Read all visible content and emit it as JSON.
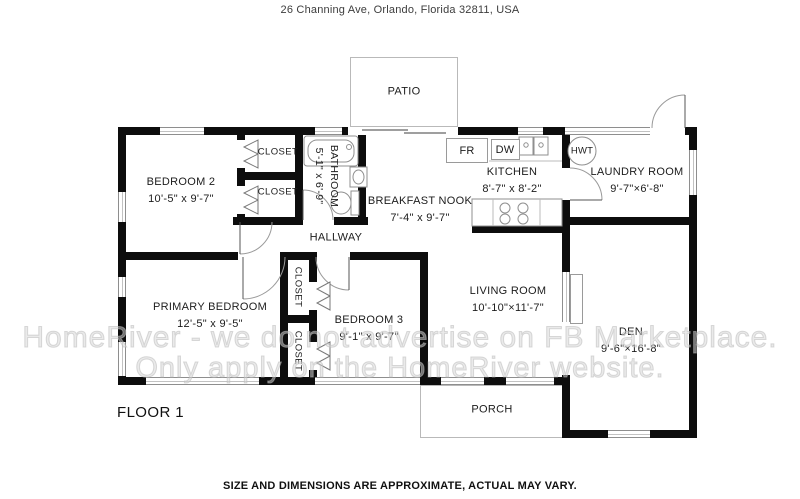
{
  "header": {
    "address": "26 Channing Ave, Orlando, Florida 32811, USA"
  },
  "watermark": {
    "line1": "HomeRiver - we do not advertise on FB Marketplace.",
    "line2": "Only apply on the HomeRiver website."
  },
  "floor": {
    "label": "FLOOR 1"
  },
  "disclaimer": {
    "text": "SIZE AND DIMENSIONS ARE APPROXIMATE, ACTUAL MAY VARY."
  },
  "rooms": {
    "bedroom2": {
      "name": "BEDROOM 2",
      "dims": "10'-5\" x 9'-7\""
    },
    "closet_a": {
      "name": "CLOSET"
    },
    "closet_b": {
      "name": "CLOSET"
    },
    "bathroom": {
      "name": "BATHROOM",
      "dims": "5'-1\" x 6'-9\""
    },
    "breakfast_nook": {
      "name": "BREAKFAST NOOK",
      "dims": "7'-4\" x 9'-7\""
    },
    "kitchen": {
      "name": "KITCHEN",
      "dims": "8'-7\" x 8'-2\""
    },
    "laundry": {
      "name": "LAUNDRY ROOM",
      "dims": "9'-7\"×6'-8\""
    },
    "hallway": {
      "name": "HALLWAY"
    },
    "primary_bedroom": {
      "name": "PRIMARY BEDROOM",
      "dims": "12'-5\" x 9'-5\""
    },
    "closet_c": {
      "name": "CLOSET"
    },
    "closet_d": {
      "name": "CLOSET"
    },
    "bedroom3": {
      "name": "BEDROOM 3",
      "dims": "9'-1\" x 9'-7\""
    },
    "living_room": {
      "name": "LIVING ROOM",
      "dims": "10'-10\"×11'-7\""
    },
    "den": {
      "name": "DEN",
      "dims": "9'-6\"×16'-8\""
    },
    "patio": {
      "name": "PATIO"
    },
    "porch": {
      "name": "PORCH"
    }
  },
  "fixtures": {
    "fridge": "FR",
    "dishwasher": "DW",
    "water_heater": "HWT"
  },
  "colors": {
    "wall": "#0d0d0d",
    "fixture_line": "#8f8f8f",
    "watermark": "#d6d6d6"
  }
}
